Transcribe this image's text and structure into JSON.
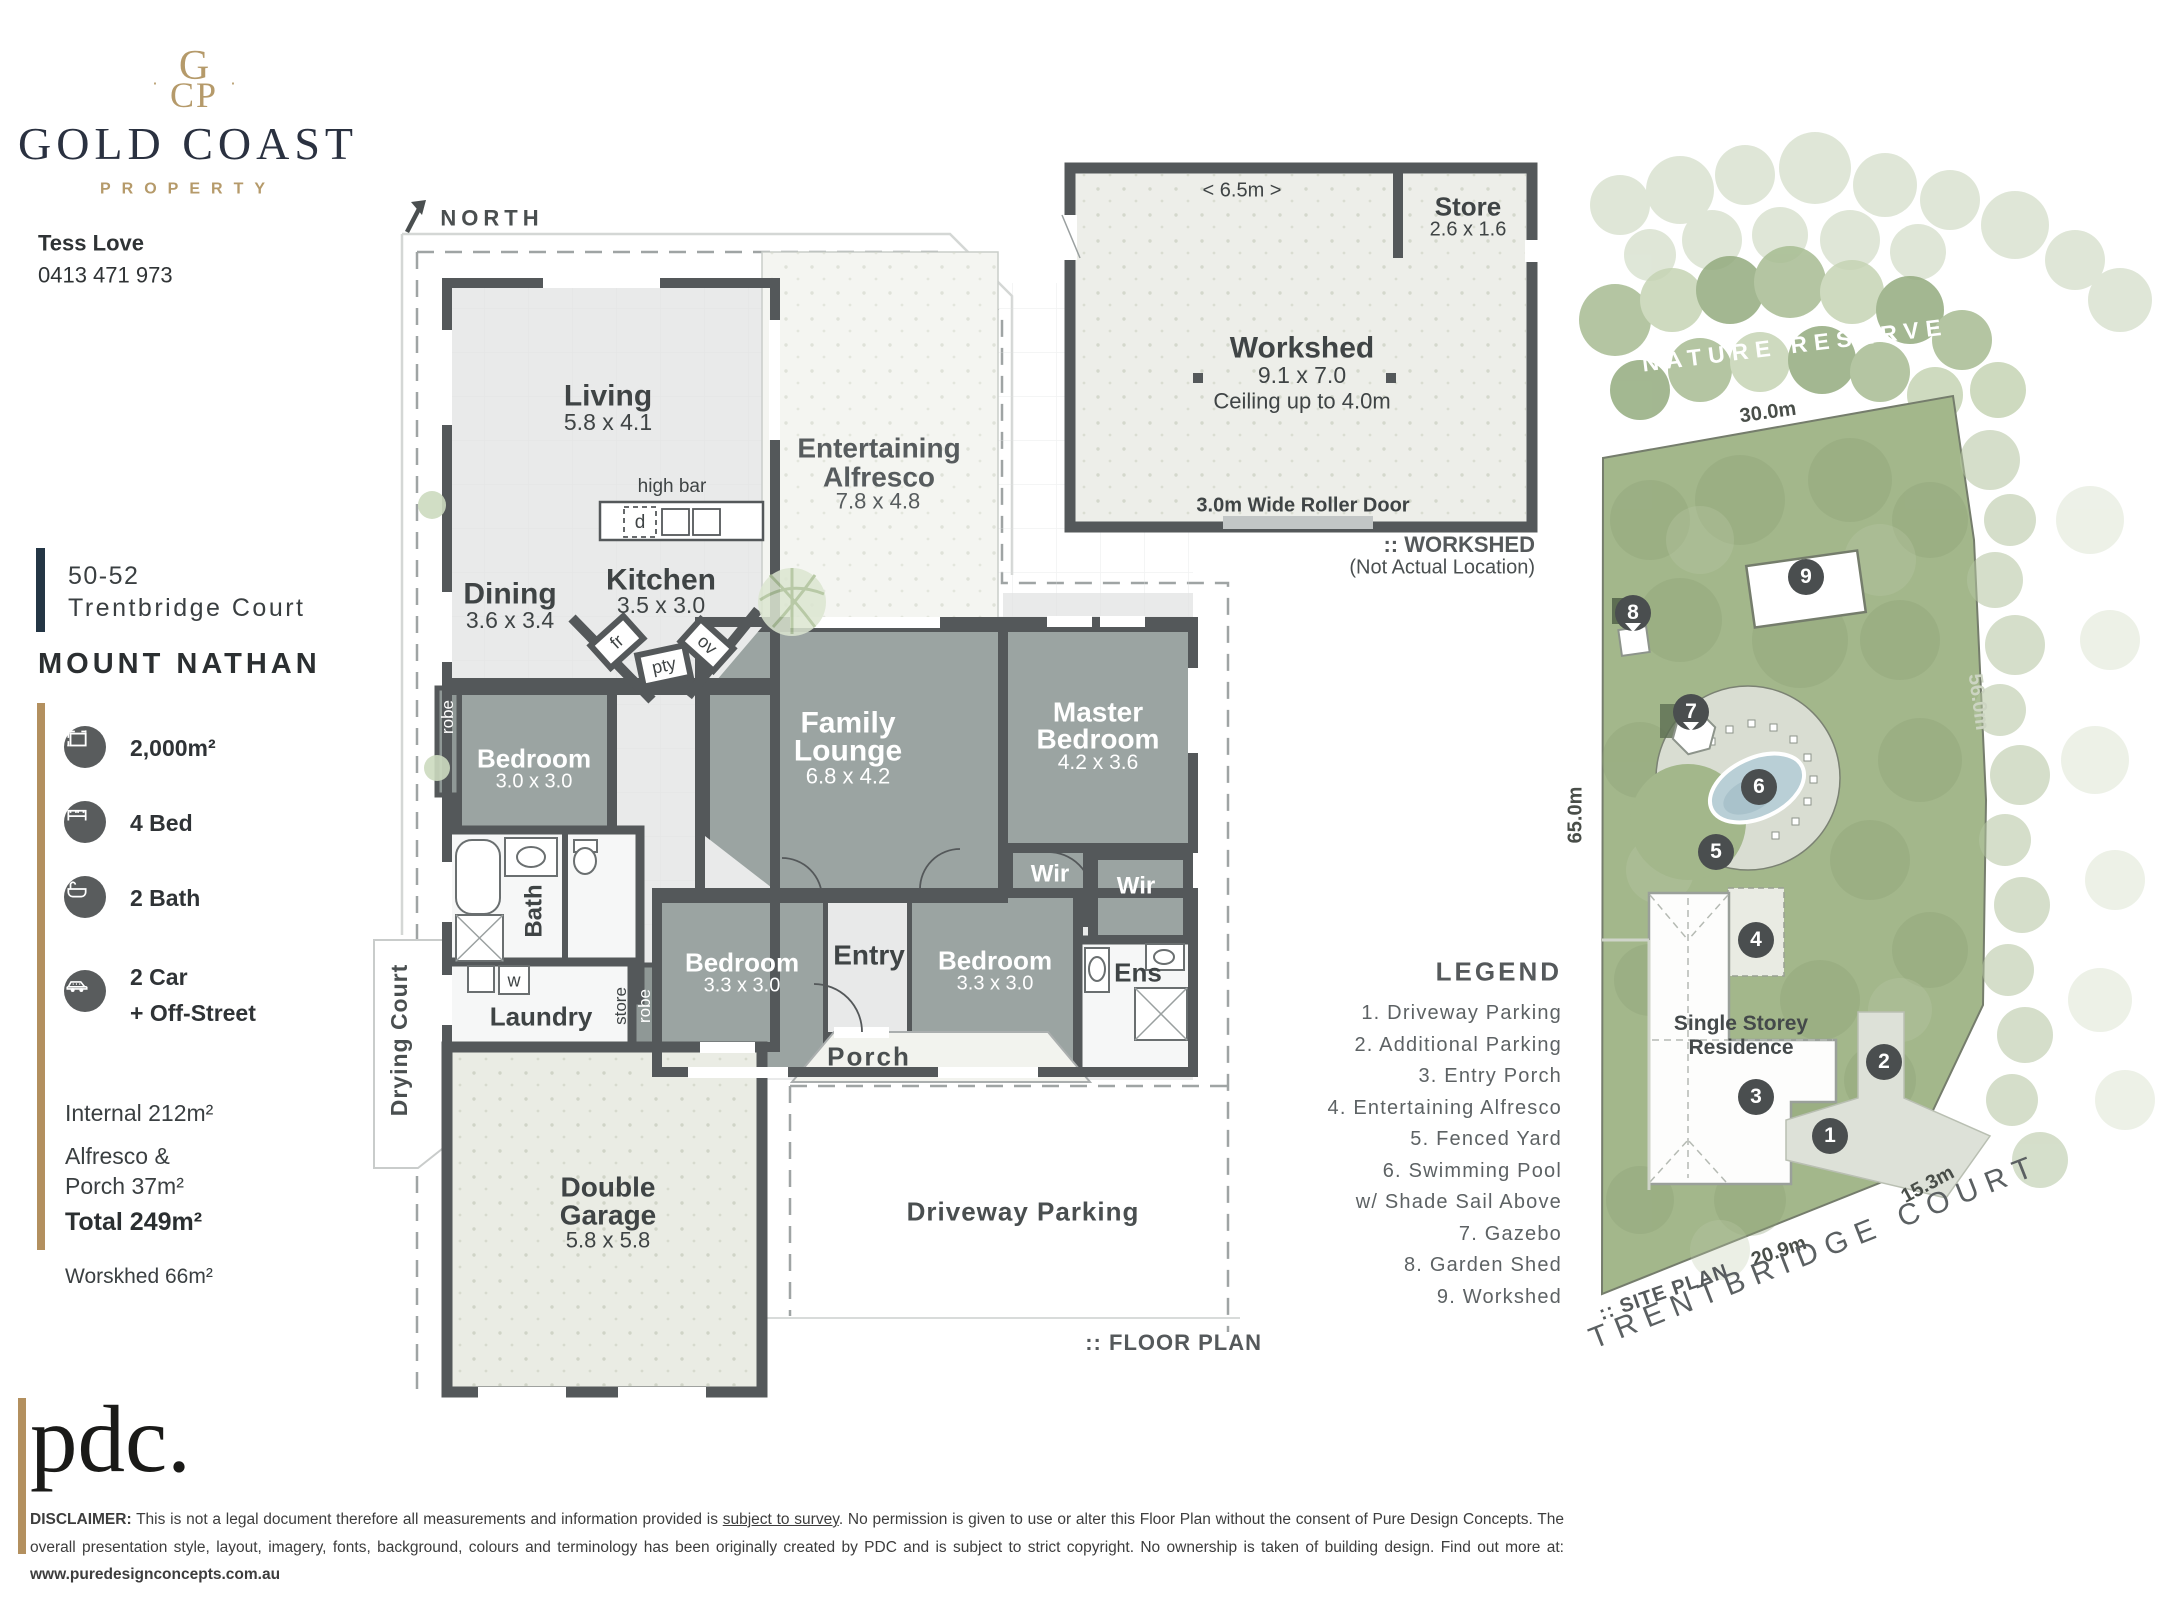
{
  "brand": {
    "monogram_top": "G",
    "monogram_bottom": "CP",
    "name": "GOLD COAST",
    "tagline": "PROPERTY",
    "agent": "Tess Love",
    "phone": "0413 471 973"
  },
  "address": {
    "street_number": "50-52",
    "street": "Trentbridge Court",
    "suburb": "MOUNT NATHAN"
  },
  "features": [
    {
      "icon": "land-area-icon",
      "label": "2,000m²"
    },
    {
      "icon": "bed-icon",
      "label": "4 Bed"
    },
    {
      "icon": "bath-icon",
      "label": "2 Bath"
    },
    {
      "icon": "car-icon",
      "label": "2 Car",
      "label2": "+ Off-Street"
    }
  ],
  "areas": {
    "internal": "Internal 212m²",
    "alfresco1": "Alfresco &",
    "alfresco2": "Porch 37m²",
    "total": "Total 249m²",
    "workshed": "Worskhed 66m²"
  },
  "north_label": "NORTH",
  "floor_plan": {
    "caption": ":: FLOOR PLAN",
    "living": "Living",
    "living_dims": "5.8 x 4.1",
    "dining": "Dining",
    "dining_dims": "3.6 x 3.4",
    "kitchen": "Kitchen",
    "kitchen_dims": "3.5 x 3.0",
    "high_bar": "high bar",
    "d": "d",
    "fr": "fr",
    "pty": "pty",
    "ov": "ov",
    "alfresco1": "Entertaining",
    "alfresco2": "Alfresco",
    "alfresco_dims": "7.8 x 4.8",
    "bedroom1": "Bedroom",
    "bedroom1_dims": "3.0 x 3.0",
    "family1": "Family",
    "family2": "Lounge",
    "family_dims": "6.8 x 4.2",
    "master1": "Master",
    "master2": "Bedroom",
    "master_dims": "4.2 x 3.6",
    "wir_a": "Wir",
    "wir_b": "Wir",
    "ens": "Ens",
    "bedroom2": "Bedroom",
    "bedroom2_dims": "3.3 x 3.0",
    "bedroom3": "Bedroom",
    "bedroom3_dims": "3.3 x 3.0",
    "entry": "Entry",
    "porch": "Porch",
    "bath": "Bath",
    "laundry": "Laundry",
    "w": "w",
    "store": "store",
    "robe1": "robe",
    "robe2": "robe",
    "drying_court": "Drying Court",
    "garage1": "Double",
    "garage2": "Garage",
    "garage_dims": "5.8 x 5.8",
    "driveway": "Driveway Parking"
  },
  "workshed_plan": {
    "width_label": "< 6.5m >",
    "store": "Store",
    "store_dims": "2.6 x 1.6",
    "name": "Workshed",
    "dims": "9.1 x 7.0",
    "ceiling": "Ceiling up to 4.0m",
    "roller": "3.0m Wide Roller Door",
    "caption": ":: WORKSHED",
    "caption_sub": "(Not Actual Location)"
  },
  "site_plan": {
    "nature_reserve": "NATURE RESERVE",
    "residence1": "Single Storey",
    "residence2": "Residence",
    "street": "TRENTBRIDGE COURT",
    "caption": ":: SITE PLAN",
    "m30": "30.0m",
    "m56": "56.0m",
    "m65": "65.0m",
    "m15": "15.3m",
    "m20": "20.9m",
    "markers": [
      "1",
      "2",
      "3",
      "4",
      "5",
      "6",
      "7",
      "8",
      "9"
    ]
  },
  "legend": {
    "title": "LEGEND",
    "items": [
      "1. Driveway Parking",
      "2. Additional Parking",
      "3. Entry Porch",
      "4. Entertaining Alfresco",
      "5. Fenced Yard",
      "6. Swimming Pool",
      "w/ Shade Sail Above",
      "7. Gazebo",
      "8. Garden Shed",
      "9. Workshed"
    ]
  },
  "footer": {
    "logo": "pdc.",
    "disclaimer_label": "DISCLAIMER:",
    "text1": " This is not a legal document therefore all measurements and information provided is ",
    "underlined": "subject to survey",
    "text2": ". No permission is given to use or alter this Floor Plan without the consent of Pure Design Concepts. The overall presentation style, layout, imagery, fonts, background, colours and terminology has been originally created by PDC and is subject to strict copyright. No ownership is taken of building design. Find out more at: ",
    "link": "www.puredesignconcepts.com.au"
  }
}
